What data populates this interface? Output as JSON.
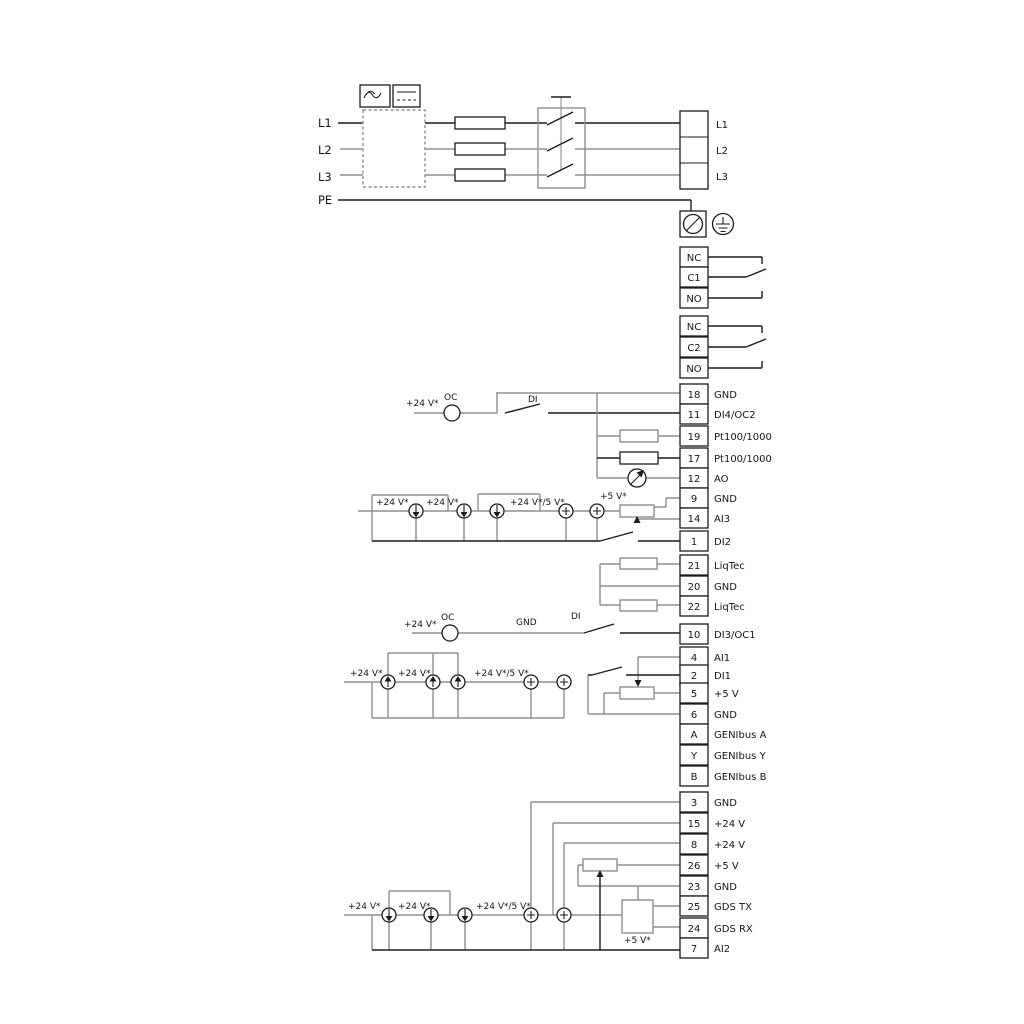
{
  "labels": {
    "v24": "+24 V*",
    "v24_5": "+24 V*/5 V*",
    "v5": "+5 V*",
    "oc": "OC",
    "di": "DI",
    "gnd": "GND"
  },
  "mains": {
    "left": [
      "L1",
      "L2",
      "L3",
      "PE"
    ],
    "right": [
      "L1",
      "L2",
      "L3"
    ]
  },
  "relay1": [
    "NC",
    "C1",
    "NO"
  ],
  "relay2": [
    "NC",
    "C2",
    "NO"
  ],
  "io": [
    {
      "n": "18",
      "l": "GND"
    },
    {
      "n": "11",
      "l": "DI4/OC2"
    },
    {
      "n": "19",
      "l": "Pt100/1000"
    },
    {
      "n": "17",
      "l": "Pt100/1000"
    },
    {
      "n": "12",
      "l": "AO"
    },
    {
      "n": "9",
      "l": "GND"
    },
    {
      "n": "14",
      "l": "AI3"
    },
    {
      "n": "1",
      "l": "DI2"
    }
  ],
  "liqtec": [
    {
      "n": "21",
      "l": "LiqTec"
    },
    {
      "n": "20",
      "l": "GND"
    },
    {
      "n": "22",
      "l": "LiqTec"
    }
  ],
  "ctrl": [
    {
      "n": "10",
      "l": "DI3/OC1"
    },
    {
      "n": "4",
      "l": "AI1"
    },
    {
      "n": "2",
      "l": "DI1"
    },
    {
      "n": "5",
      "l": "+5 V"
    },
    {
      "n": "6",
      "l": "GND"
    },
    {
      "n": "A",
      "l": "GENIbus A"
    },
    {
      "n": "Y",
      "l": "GENIbus Y"
    },
    {
      "n": "B",
      "l": "GENIbus B"
    }
  ],
  "power": [
    {
      "n": "3",
      "l": "GND"
    },
    {
      "n": "15",
      "l": "+24 V"
    },
    {
      "n": "8",
      "l": "+24 V"
    },
    {
      "n": "26",
      "l": "+5 V"
    },
    {
      "n": "23",
      "l": "GND"
    },
    {
      "n": "25",
      "l": "GDS TX"
    },
    {
      "n": "24",
      "l": "GDS RX"
    },
    {
      "n": "7",
      "l": "AI2"
    }
  ],
  "colors": {
    "wire_gray": "#8f8f8f",
    "wire_black": "#1c1c1c"
  }
}
